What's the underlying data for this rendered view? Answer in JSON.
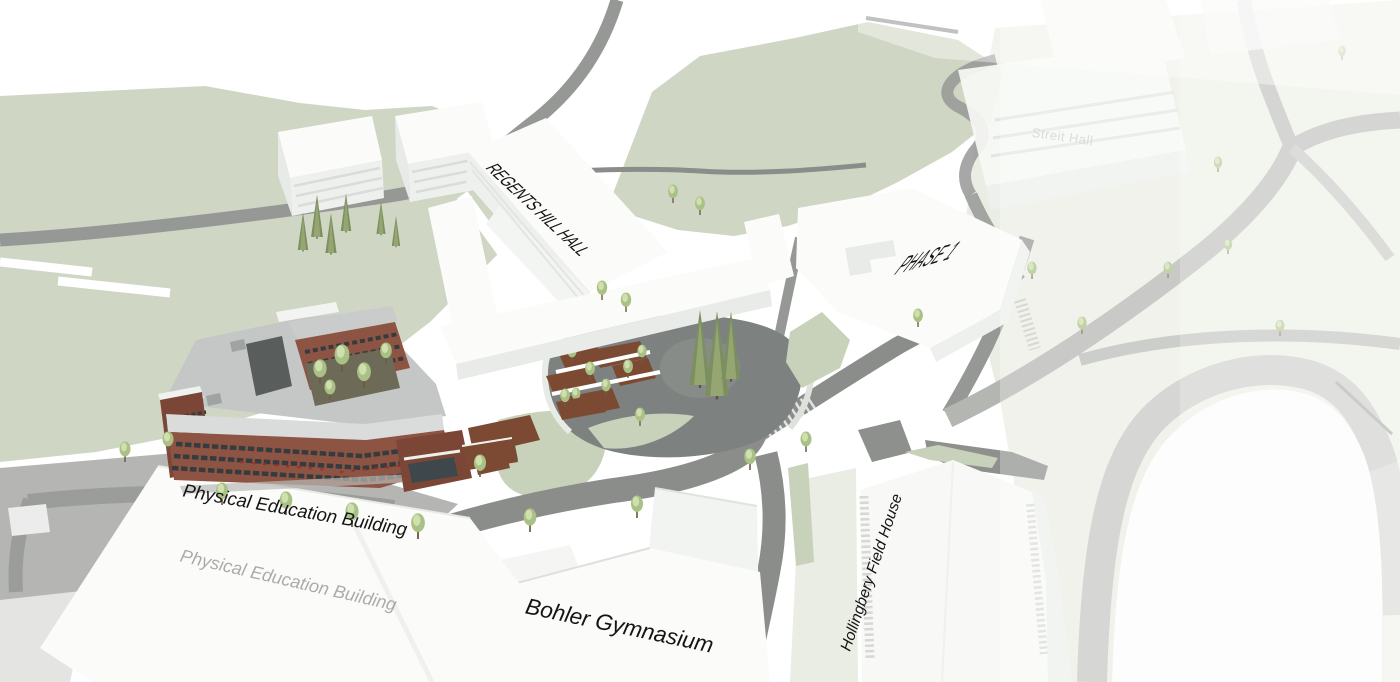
{
  "scene": {
    "type": "architectural-aerial-site-rendering",
    "labels": {
      "regents_hill_hall": "REGENTS HILL HALL",
      "phase_1": "PHASE 1",
      "streit_hall": "Streit Hall",
      "physical_education_building": "Physical Education Building",
      "bohler_gymnasium": "Bohler Gymnasium",
      "hollingbery_field_house": "Hollingbery Field House"
    },
    "colors": {
      "ground_green": "#cfd6c4",
      "ground_green_pale": "#eaede3",
      "lawn_green": "#c8d1ba",
      "road_gray": "#969896",
      "road_dark": "#8b8d8b",
      "road_pale": "#b4b6b2",
      "lot_gray": "#b5b6b4",
      "plaza_gray": "#7d8280",
      "building_white": "#fbfcfa",
      "building_shade": "#eef0ed",
      "roof_gray": "#c4c7c6",
      "brick_red": "#8d5444",
      "brick_dark": "#7c4637",
      "window_dark": "#353b3e",
      "accent_red": "#9e2f28",
      "soil_brown": "#7c4a33",
      "courtyard_dark": "#6e6a58",
      "rock_gray": "#595e5c",
      "tree_green": "#a9c185",
      "tree_light": "#cfdfae",
      "conifer_green": "#7c8f5e",
      "track_gray": "#c6c8c5",
      "label_black": "#141414",
      "label_faint": "#d9ddd6"
    }
  }
}
